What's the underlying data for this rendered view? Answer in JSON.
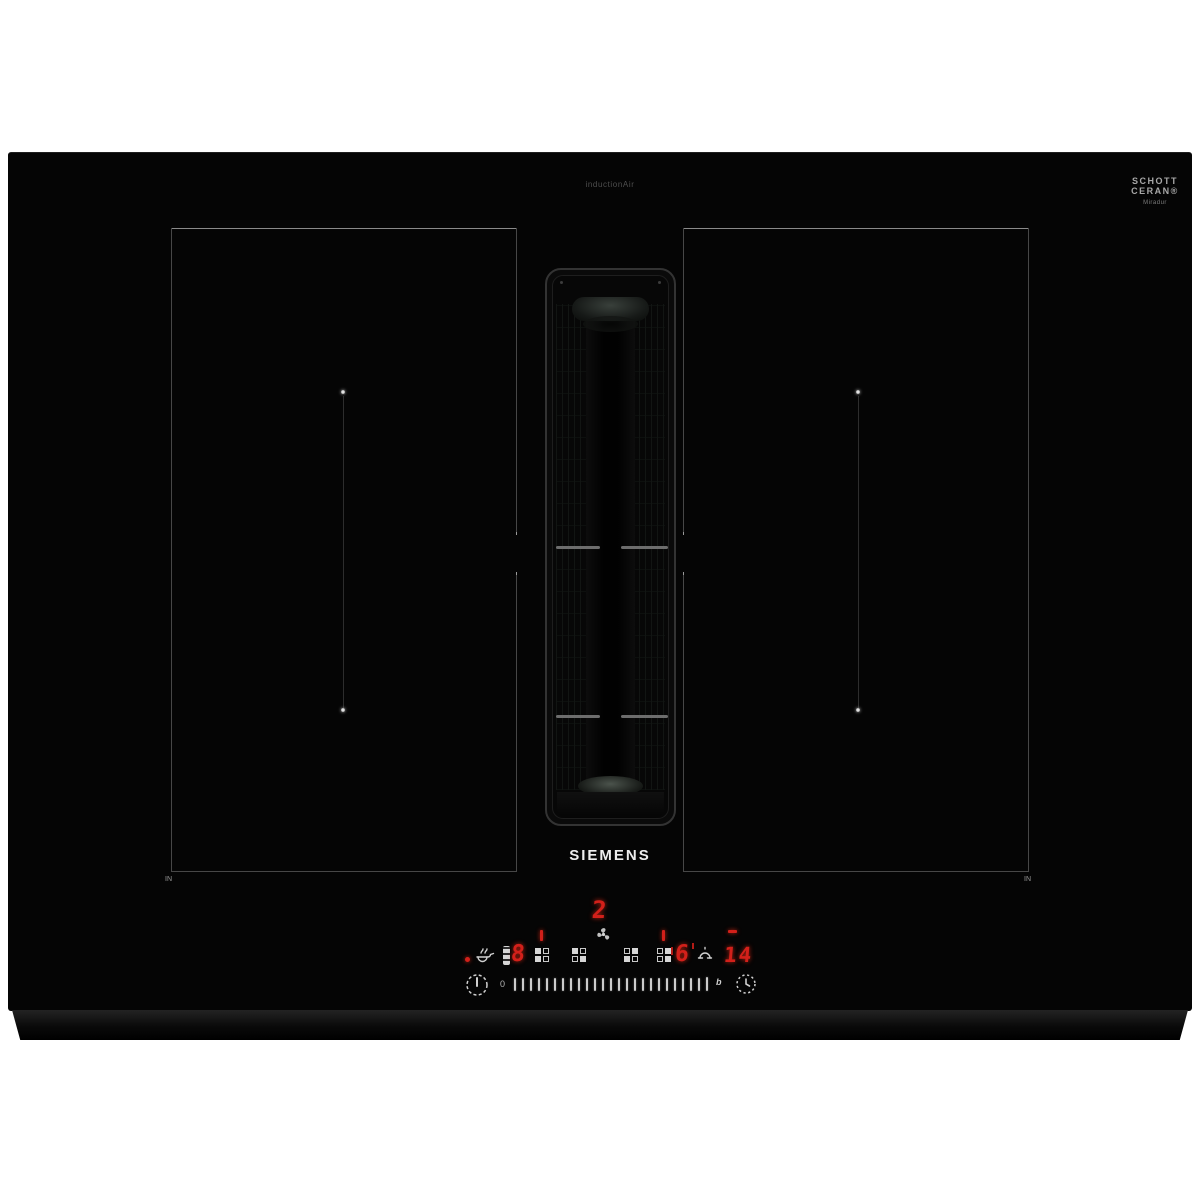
{
  "branding": {
    "model_label": "inductionAir",
    "glass_brand_line1": "SCHOTT",
    "glass_brand_line2": "CERAN®",
    "glass_brand_subline": "Miradur",
    "manufacturer_logo": "SIEMENS"
  },
  "surface": {
    "left_zone_corner_label": "IN",
    "right_zone_corner_label": "IN"
  },
  "control_panel": {
    "fan_level_display": "2",
    "left_zone_power_display": "8",
    "right_zone_power_display": "6",
    "timer_display": "14",
    "slider_zero_label": "0",
    "slider_boost_label": "b",
    "slider_tick_count": 25
  },
  "colors": {
    "led_red": "#d2201a",
    "icon_white": "#d6d6d6",
    "glass_black": "#050505"
  }
}
